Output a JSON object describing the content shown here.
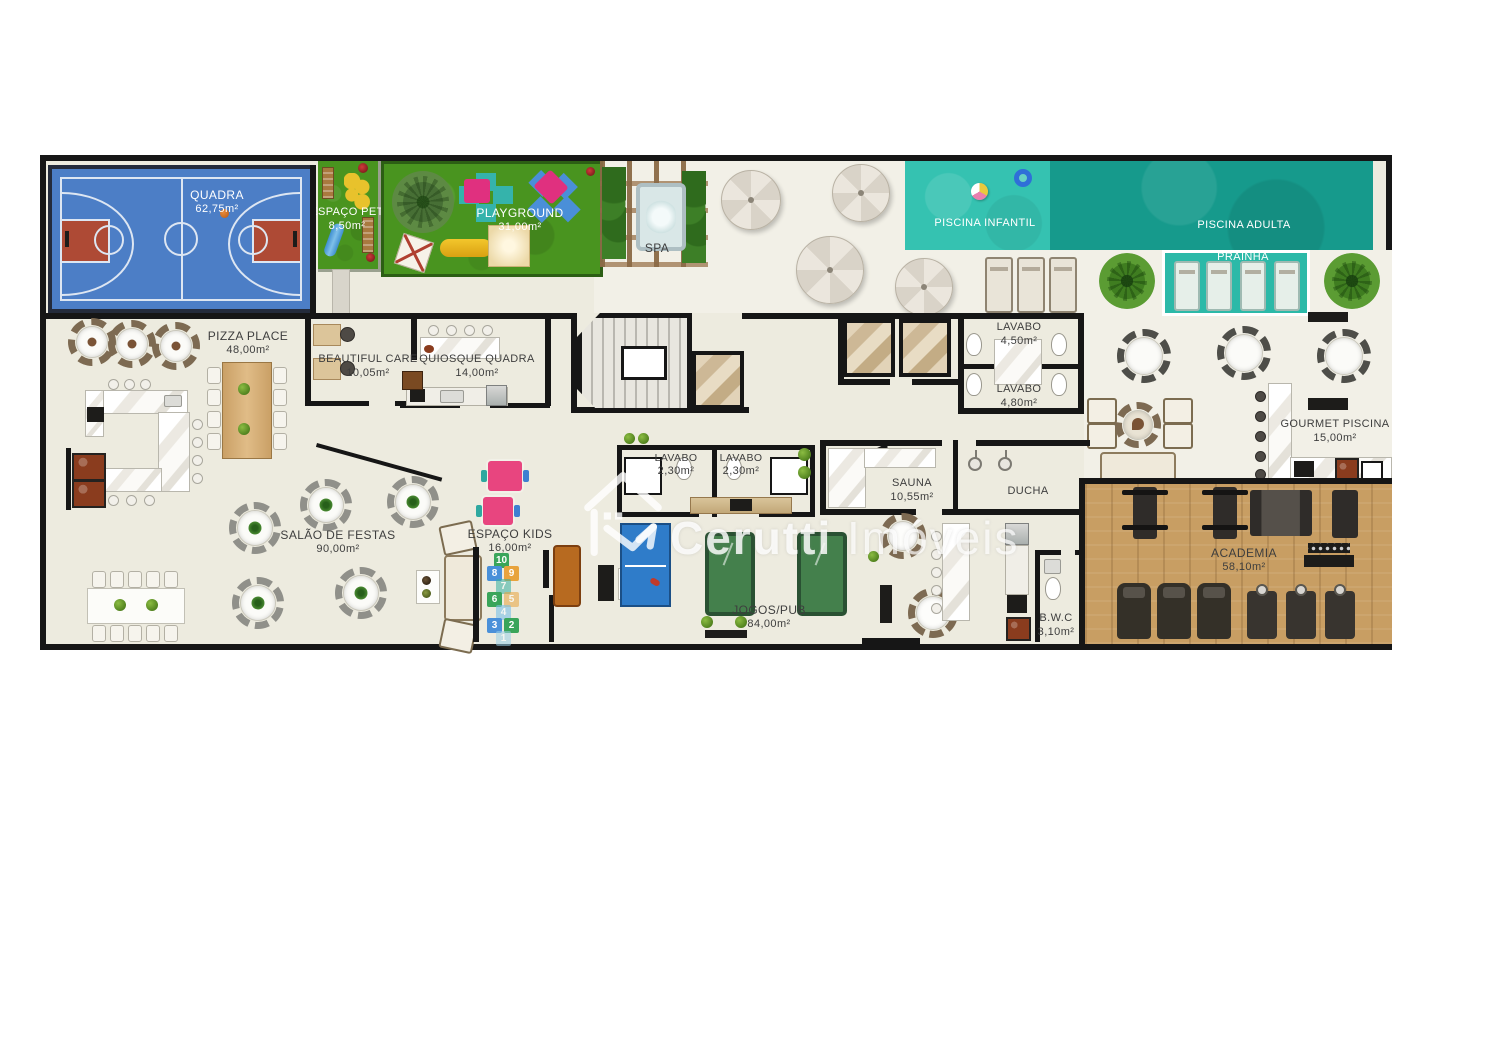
{
  "watermark": {
    "brand_primary": "Cerutti",
    "brand_secondary": "Imóveis",
    "logo": "house-roof-arrow-icon"
  },
  "rooms": {
    "quadra": {
      "name": "QUADRA",
      "area": "62,75m²"
    },
    "espaco_pet": {
      "name": "ESPAÇO PET",
      "area": "8,50m²"
    },
    "playground": {
      "name": "PLAYGROUND",
      "area": "31,00m²"
    },
    "spa": {
      "name": "SPA"
    },
    "piscina_infantil": {
      "name": "PISCINA INFANTIL"
    },
    "piscina_adulta": {
      "name": "PISCINA ADULTA"
    },
    "prainha": {
      "name": "PRAINHA"
    },
    "pizza_place": {
      "name": "PIZZA PLACE",
      "area": "48,00m²"
    },
    "beautiful_care": {
      "name": "BEAUTIFUL CARE",
      "area": "10,05m²"
    },
    "quiosque_quadra": {
      "name": "QUIOSQUE QUADRA",
      "area": "14,00m²"
    },
    "lavabo_1": {
      "name": "LAVABO",
      "area": "4,50m²"
    },
    "lavabo_2": {
      "name": "LAVABO",
      "area": "4,80m²"
    },
    "lavabo_3": {
      "name": "LAVABO",
      "area": "2,30m²"
    },
    "lavabo_4": {
      "name": "LAVABO",
      "area": "2,30m²"
    },
    "sauna": {
      "name": "SAUNA",
      "area": "10,55m²"
    },
    "ducha": {
      "name": "DUCHA"
    },
    "salao_de_festas": {
      "name": "SALÃO DE FESTAS",
      "area": "90,00m²"
    },
    "espaco_kids": {
      "name": "ESPAÇO KIDS",
      "area": "16,00m²"
    },
    "jogos_pub": {
      "name": "JOGOS/PUB",
      "area": "84,00m²"
    },
    "gourmet_piscina": {
      "name": "GOURMET PISCINA",
      "area": "15,00m²"
    },
    "academia": {
      "name": "ACADEMIA",
      "area": "58,10m²"
    },
    "bwc": {
      "name": "B.W.C",
      "area": "3,10m²"
    }
  },
  "hopscotch_numbers": [
    "10",
    "8",
    "9",
    "7",
    "6",
    "5",
    "4",
    "3",
    "2",
    "1"
  ],
  "colors": {
    "wall": "#161616",
    "floor": "#edebdf",
    "deck": "#f2f0e7",
    "court_blue": "#4c7ec6",
    "court_key_red": "#ae4a35",
    "grass_green": "#49941f",
    "pool_light": "#35c2b1",
    "pool_dark": "#169a8c",
    "prainha_teal": "#2cb9a8",
    "gym_wood": "#c89e63",
    "marble": "#f5f3ee",
    "label_dark": "#3e3e3e",
    "label_light": "#ffffff"
  }
}
